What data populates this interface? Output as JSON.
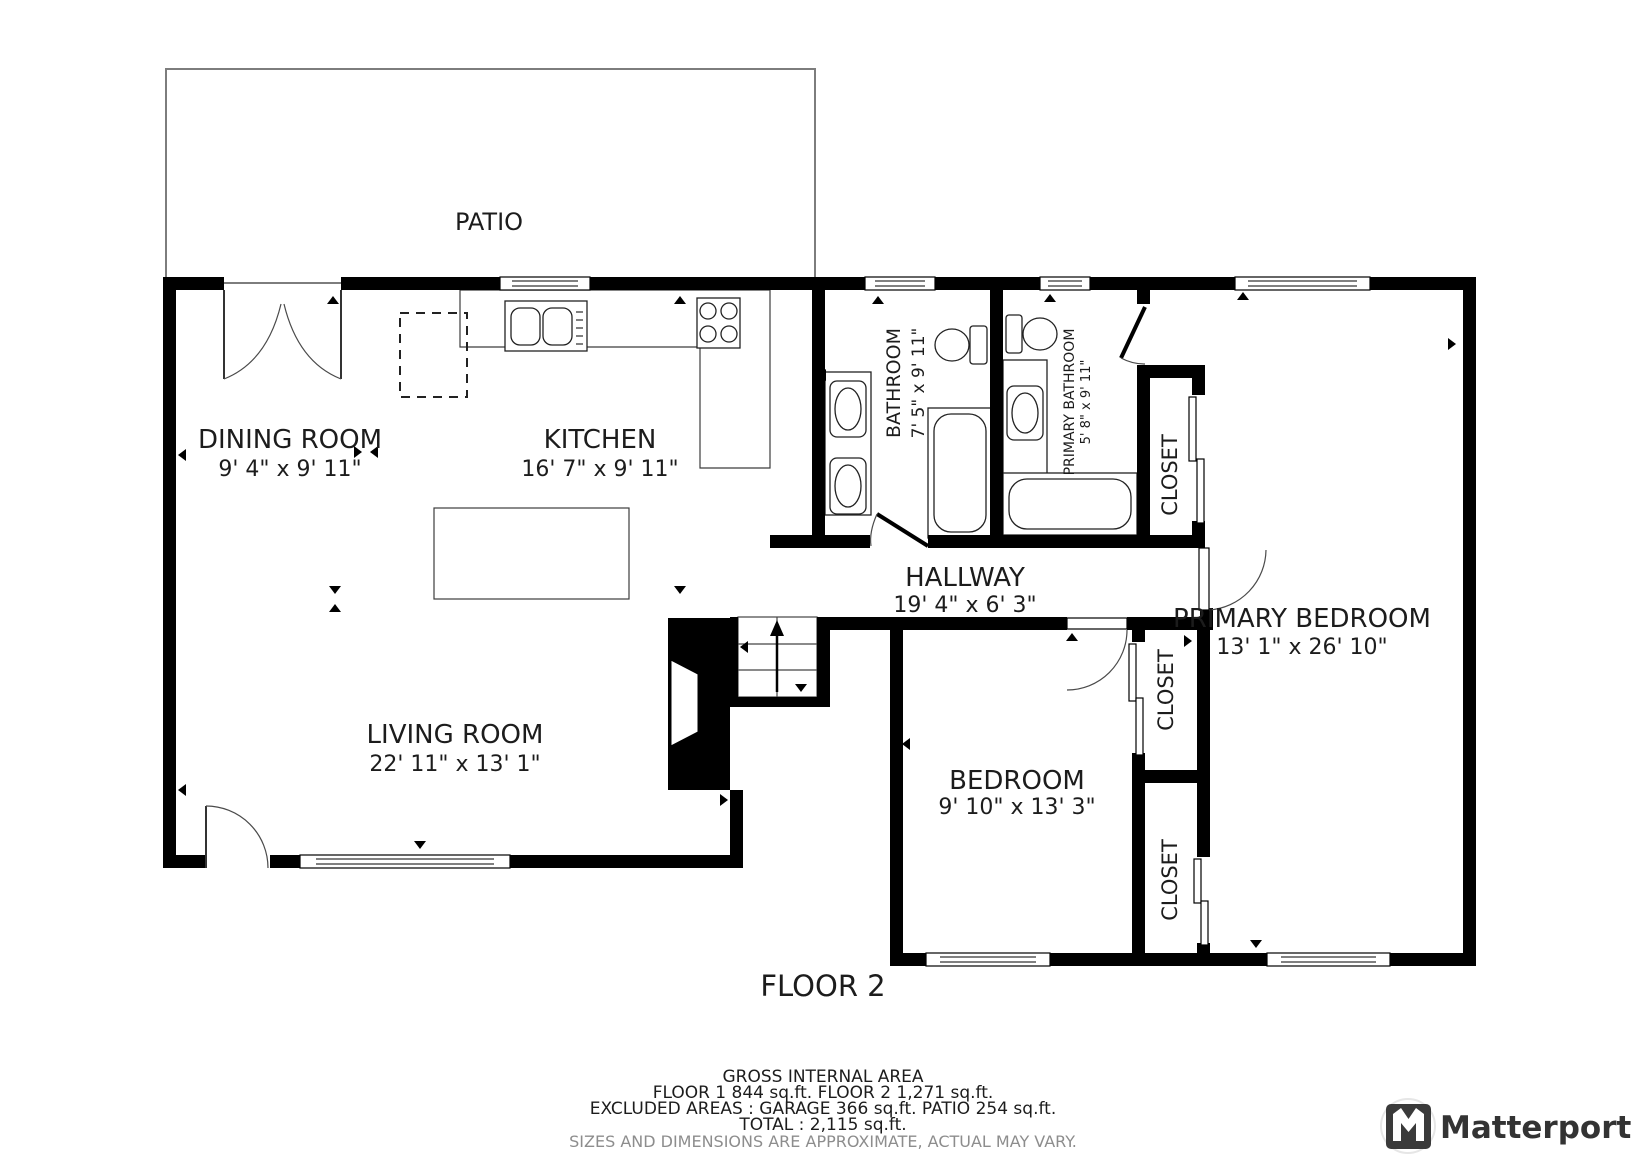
{
  "plan": {
    "patio_label": "PATIO",
    "floor_label": "FLOOR 2",
    "rooms": {
      "dining": {
        "name": "DINING ROOM",
        "dims": "9' 4\" x 9' 11\""
      },
      "kitchen": {
        "name": "KITCHEN",
        "dims": "16' 7\" x 9' 11\""
      },
      "living": {
        "name": "LIVING ROOM",
        "dims": "22' 11\" x 13' 1\""
      },
      "hallway": {
        "name": "HALLWAY",
        "dims": "19' 4\" x 6' 3\""
      },
      "bathroom": {
        "name": "BATHROOM",
        "dims": "7' 5\" x 9' 11\""
      },
      "primary_bathroom": {
        "name": "PRIMARY BATHROOM",
        "dims": "5' 8\" x 9' 11\""
      },
      "bedroom": {
        "name": "BEDROOM",
        "dims": "9' 10\" x 13' 3\""
      },
      "primary_bedroom": {
        "name": "PRIMARY BEDROOM",
        "dims": "13' 1\" x 26' 10\""
      },
      "closet_primary": {
        "name": "CLOSET"
      },
      "closet_bedroom_top": {
        "name": "CLOSET"
      },
      "closet_bedroom_bottom": {
        "name": "CLOSET"
      }
    }
  },
  "footer": {
    "title": "GROSS INTERNAL AREA",
    "line_floors": "FLOOR 1 844 sq.ft.   FLOOR 2 1,271 sq.ft.",
    "line_excluded": "EXCLUDED AREAS :  GARAGE 366 sq.ft.   PATIO 254 sq.ft.",
    "line_total": "TOTAL :  2,115 sq.ft.",
    "disclaimer": "SIZES AND DIMENSIONS ARE APPROXIMATE, ACTUAL MAY VARY."
  },
  "branding": {
    "logo_text": "Matterport"
  },
  "colors": {
    "wall": "#000000",
    "background": "#ffffff",
    "disclaimer_text": "#8d8d8d",
    "logo": "#3a3a3a"
  }
}
